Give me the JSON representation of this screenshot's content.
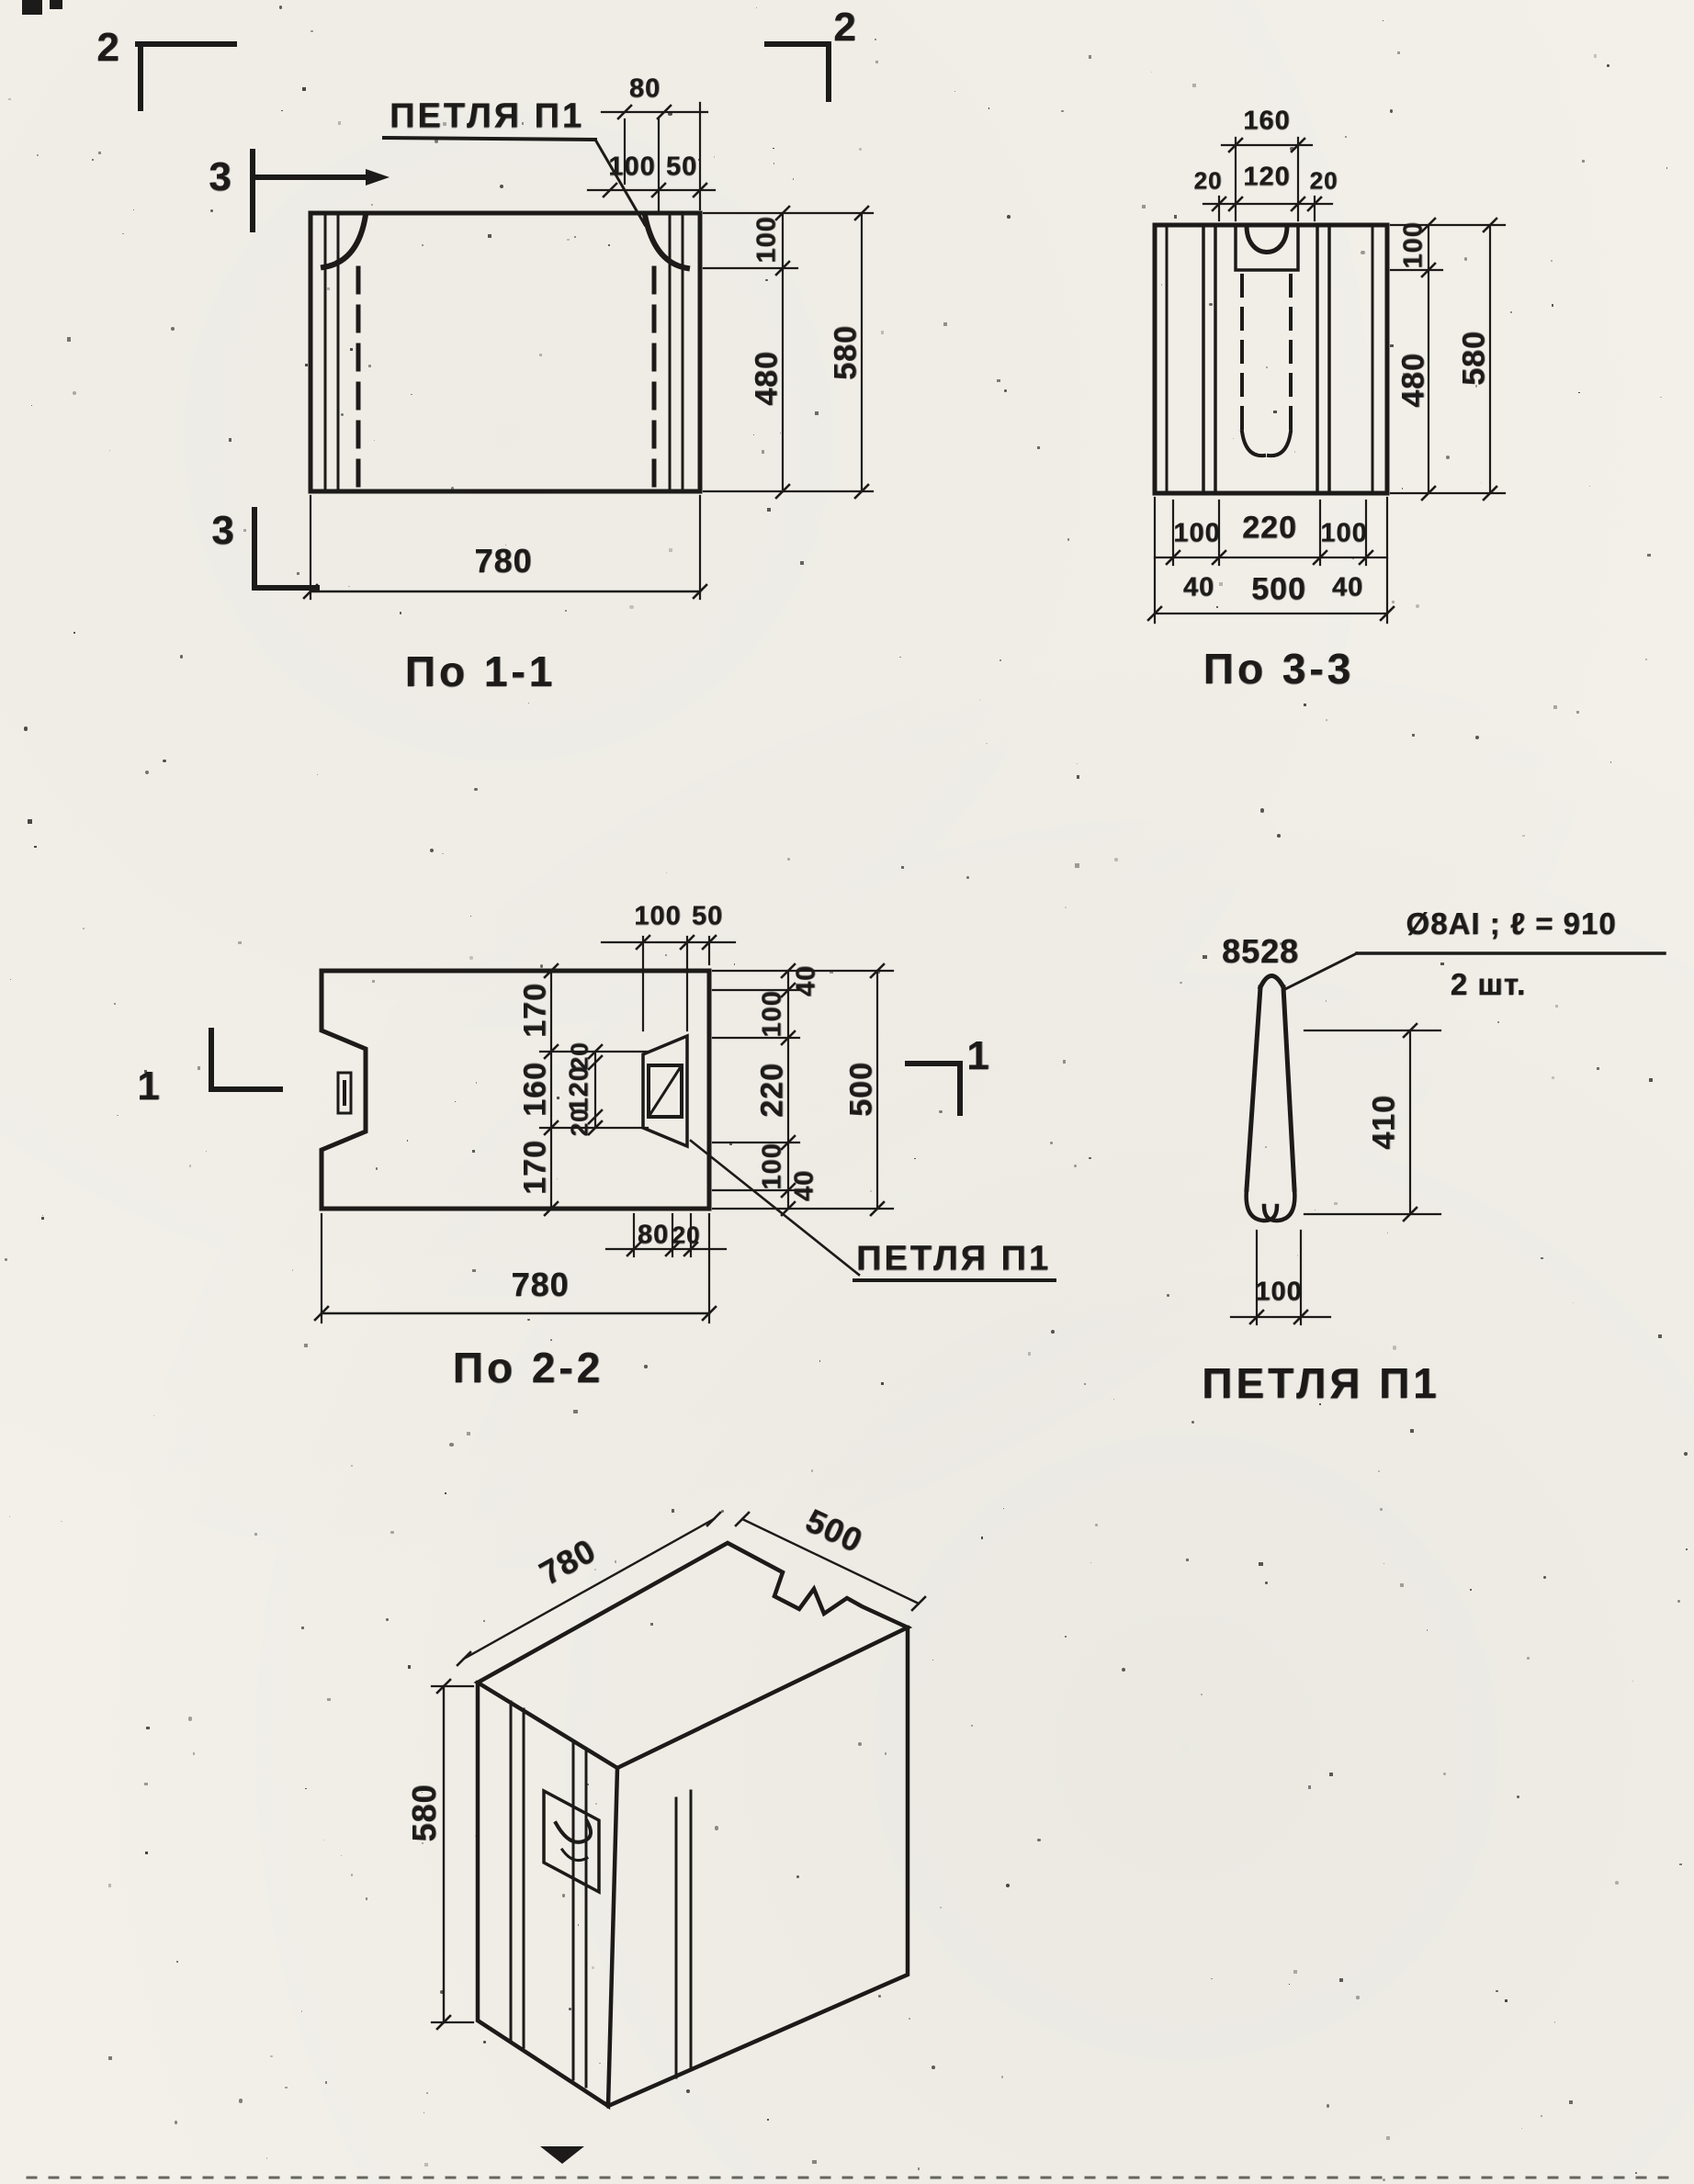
{
  "paper": {
    "bg": "#f2f0e9",
    "ink": "#1c1b19"
  },
  "view11": {
    "title": "По 1-1",
    "loop_label": "ПЕТЛЯ П1",
    "dims": {
      "hook": "80",
      "top_a": "100",
      "top_b": "50",
      "right_a": "100",
      "right_b": "480",
      "right_total": "580",
      "bottom": "780"
    },
    "markers": {
      "top_left": "2",
      "top_right": "2",
      "side_top": "3",
      "side_bottom": "3"
    }
  },
  "view33": {
    "title": "По 3-3",
    "dims": {
      "top_total": "160",
      "top_a": "20",
      "top_b": "120",
      "top_c": "20",
      "right_a": "100",
      "right_b": "480",
      "right_total": "580",
      "bot_a": "100",
      "bot_b": "220",
      "bot_c": "100",
      "bot_left": "40",
      "bot_total": "500",
      "bot_right": "40"
    }
  },
  "view22": {
    "title": "По 2-2",
    "loop_label": "ПЕТЛЯ П1",
    "markers": {
      "left": "1",
      "right": "1"
    },
    "dims": {
      "top_a": "100",
      "top_b": "50",
      "left_a": "170",
      "left_b": "160",
      "left_c": "170",
      "mid_a": "20",
      "mid_b": "120",
      "mid_c": "20",
      "right_40_top": "40",
      "right_a": "100",
      "right_b": "220",
      "right_c": "100",
      "right_40_bot": "40",
      "right_total": "500",
      "bot_a": "80",
      "bot_b": "20",
      "bottom": "780"
    }
  },
  "loop_detail": {
    "title": "ПЕТЛЯ П1",
    "spec": "8528",
    "note_spec": "Ø8АI ; ℓ = 910",
    "note_qty": "2 шт.",
    "height": "410",
    "width": "100"
  },
  "iso": {
    "width": "780",
    "depth": "500",
    "height": "580"
  }
}
